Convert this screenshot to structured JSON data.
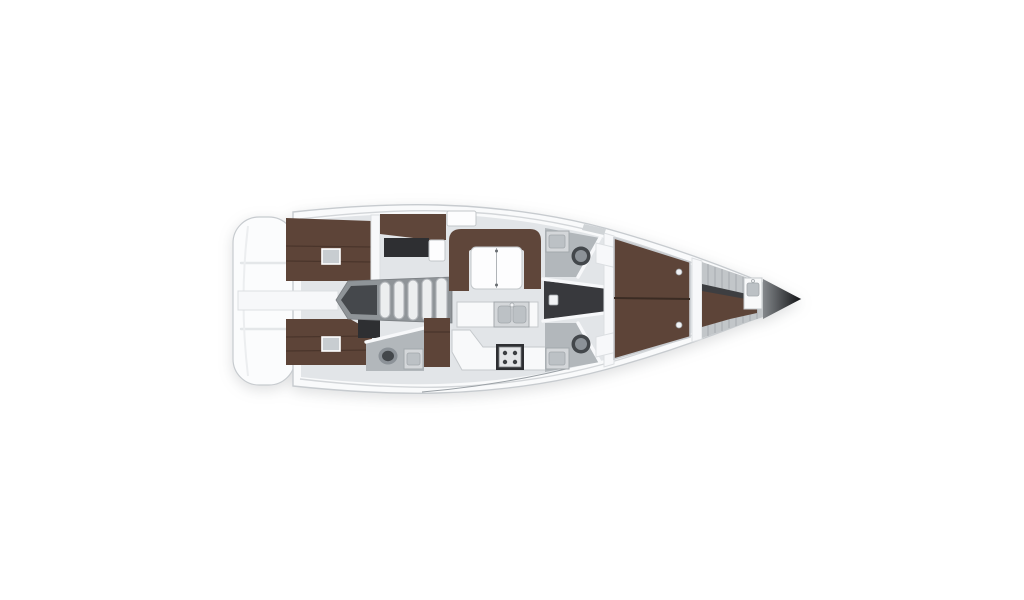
{
  "page": {
    "background": "#ffffff"
  },
  "colors": {
    "page_bg": "#ffffff",
    "hull_fill": "#f9fafb",
    "hull_stroke": "#c7cbcf",
    "transom_fill": "#fbfcfd",
    "transom_line": "#e4e7e9",
    "deck_line": "#d3d6d9",
    "thin_line": "#9aa0a5",
    "interior_floor": "#e2e5e8",
    "berth_brown": "#5d4438",
    "berth_seam": "#4a352b",
    "berth_frame": "#c8ccd0",
    "settee_brown": "#5f463a",
    "wall_white": "#f7f8fa",
    "wall_stroke": "#dcdfe2",
    "counter_white": "#f8f9fa",
    "counter_stroke": "#c5c9cc",
    "fixture_gray": "#d4d7da",
    "fixture_deep": "#bcc1c5",
    "fixture_stroke": "#a3a8ac",
    "head_floor": "#b2b7bb",
    "dark_unit": "#2e2f32",
    "passage_dark": "#38393d",
    "steps_housing": "#8f9498",
    "steps_housing_edge": "#797d81",
    "steps_dark": "#45484c",
    "tread_fill": "#eceeef",
    "tread_stroke": "#aeb2b6",
    "toilet_dark": "#43474b",
    "toilet_light": "#8c9298",
    "slat_gray": "#c2c6c9",
    "slat_line": "#a6abaf",
    "hatch_fill": "#c8cdd1",
    "table_white": "#fdfdfe",
    "table_stroke": "#c3c7ca",
    "dot_light": "#f2f3f5",
    "bow_tip_light": "#84888c",
    "bow_tip_dark": "#121315",
    "centerline_dark": "#3a2b23"
  },
  "diagram": {
    "type": "floor-plan",
    "subject": "sailing-yacht-interior-layout",
    "view": "top-down",
    "orientation": "bow-right-stern-left",
    "rooms": [
      "swim-platform",
      "port-aft-cabin",
      "starboard-aft-cabin",
      "companionway-steps",
      "nav-station",
      "aft-head",
      "saloon-settee",
      "saloon-table",
      "galley",
      "port-forward-head",
      "starboard-forward-head",
      "forward-passage",
      "owners-cabin-berth",
      "crew-cabin",
      "anchor-locker"
    ]
  }
}
